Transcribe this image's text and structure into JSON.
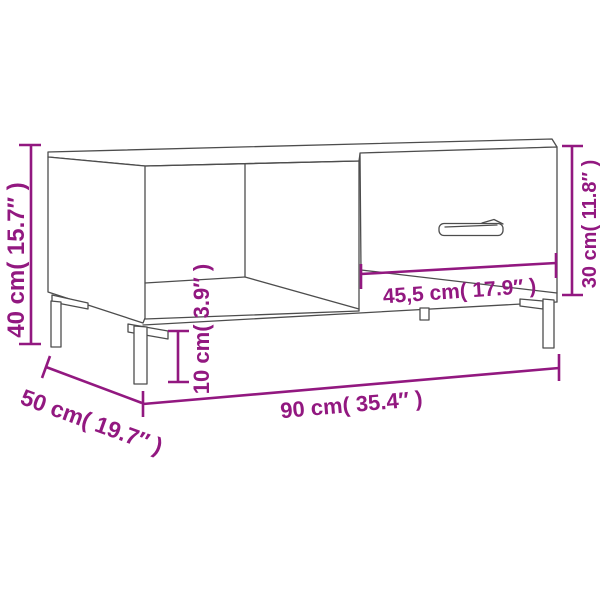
{
  "page": {
    "background": "#FFFFFF",
    "subject": "coffee table line drawing with open shelf, drawer and metal legs"
  },
  "colors": {
    "dimension_accent": "#921880",
    "line_art": "#4D4D4D",
    "background": "#FFFFFF"
  },
  "dimensions": {
    "overall_height": {
      "label": "40 cm( 15.7″ )",
      "cm": "40",
      "inches": "15.7"
    },
    "depth": {
      "label": "50 cm( 19.7″ )",
      "cm": "50",
      "inches": "19.7"
    },
    "overall_width": {
      "label": "90 cm( 35.4″ )",
      "cm": "90",
      "inches": "35.4"
    },
    "leg_height": {
      "label": "10 cm( 3.9″ )",
      "cm": "10",
      "inches": "3.9"
    },
    "drawer_width": {
      "label": "45,5 cm( 17.9″ )",
      "cm": "45,5",
      "inches": "17.9"
    },
    "drawer_height": {
      "label": "30 cm( 11.8″ )",
      "cm": "30",
      "inches": "11.8"
    }
  }
}
